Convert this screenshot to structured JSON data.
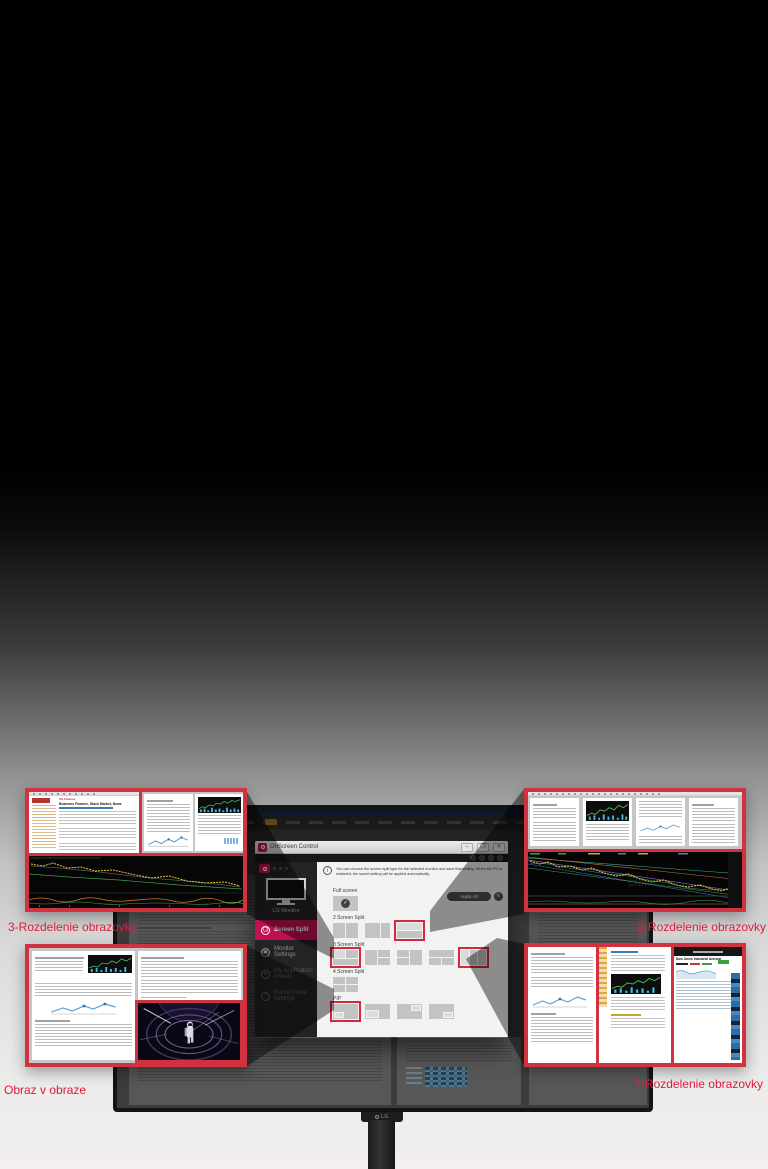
{
  "labels": {
    "top_left": "3-Rozdelenie obrazovky",
    "top_right": "2-Rozdelenie obrazovky",
    "bottom_left": "Obraz v obraze",
    "bottom_right": "3-Rozdelenie obrazovky"
  },
  "monitor": {
    "brand": "LG"
  },
  "osc": {
    "title": "OnScreen Control",
    "window_icons": {
      "minimize": "–",
      "maximize": "❐",
      "close": "✕"
    },
    "info_icon": "i",
    "description": "You can choose the screen split type for the selected monitor and save that setting. When the PC is restarted, the saved setting will be applied automatically.",
    "apply_all": "Apply All",
    "apply_icon": "↻",
    "check_icon": "✓",
    "sidebar": {
      "monitor_label": "LG Monitor",
      "items": [
        {
          "label": "Screen Split",
          "icon": "❏"
        },
        {
          "label": "Monitor Settings",
          "icon": "▣"
        },
        {
          "label": "My Application Preset",
          "icon": "✦"
        },
        {
          "label": "Game mode settings",
          "icon": "⌃"
        }
      ]
    },
    "sections": {
      "full": "Full screen",
      "two": "2 Screen Split",
      "three": "3 Screen Split",
      "four": "4 Screen Split",
      "pip": "PIP"
    }
  },
  "thumb_content": {
    "news_kicker": "US Finance",
    "news_title": "Business Finance, Stock Market, News",
    "site_title": "Dow Jones Industrial Average",
    "chart_watermark": "CNX"
  },
  "colors": {
    "accent_red": "#d2313f",
    "label_red": "#e01a3c",
    "active_pink": "#c01052"
  }
}
